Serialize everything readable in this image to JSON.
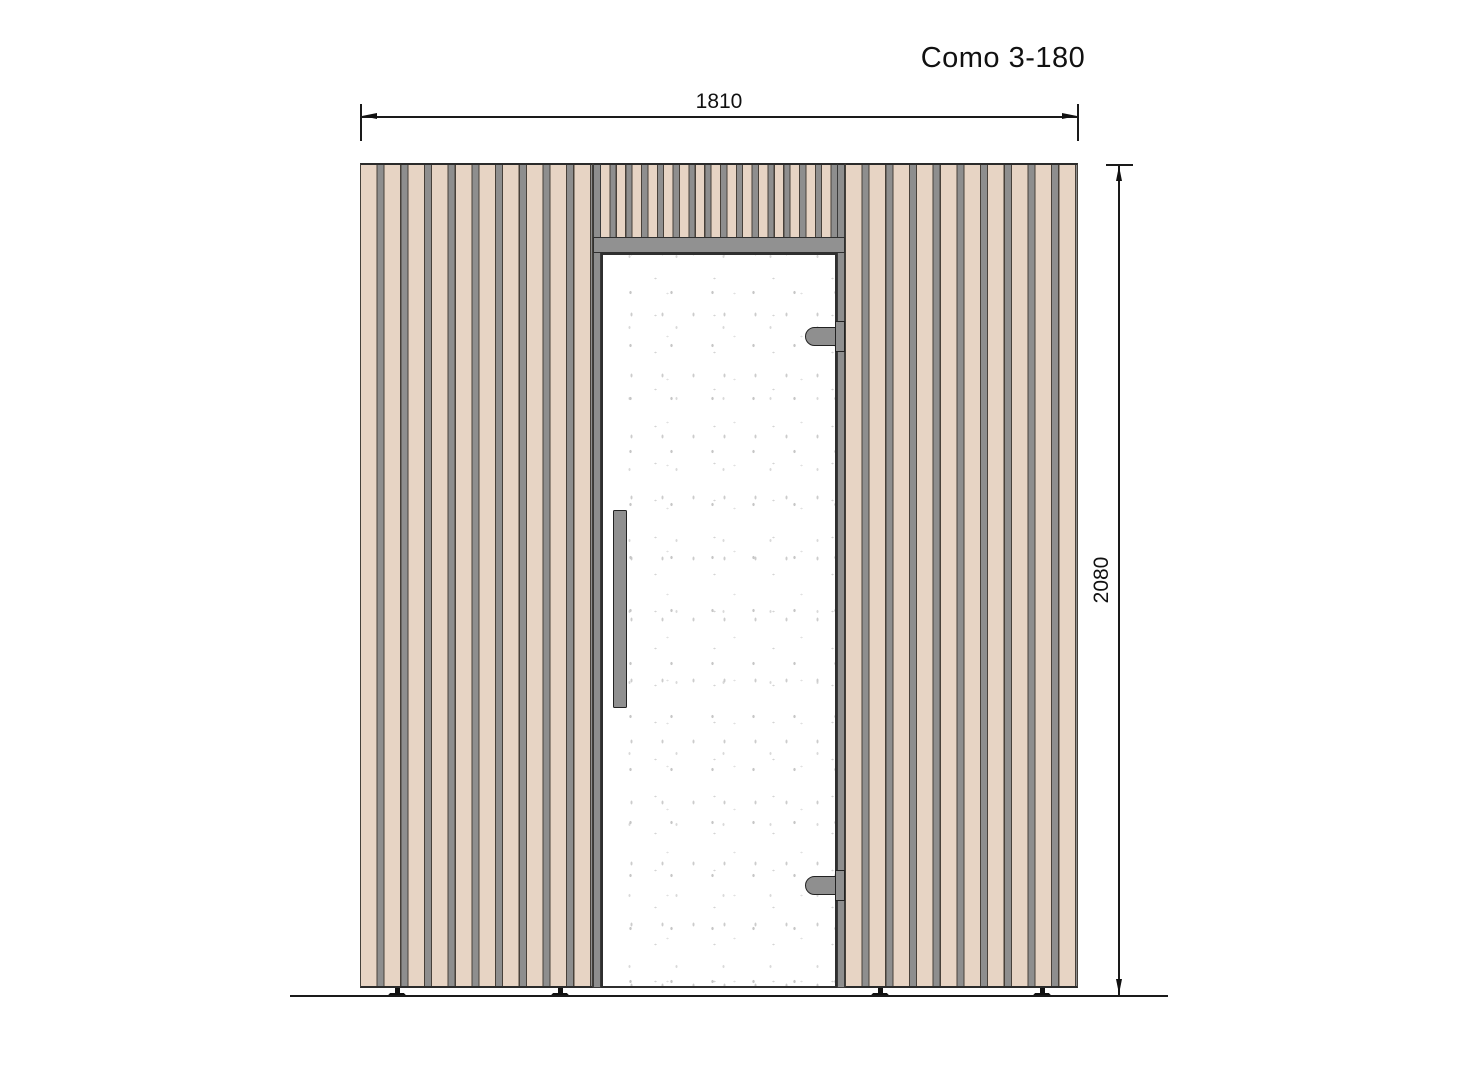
{
  "drawing": {
    "title": "Como 3-180",
    "view": "front elevation of sauna cabin with vertical slat cladding and glass door",
    "dimensions": {
      "width_mm": "1810",
      "height_mm": "2080"
    },
    "elements": {
      "door": "full-height glass door with vertical bar handle",
      "hinge_count": 2,
      "feet_count": 4
    },
    "colors": {
      "slat_beige": "#e7d4c4",
      "batten_gray": "#8e8e8e",
      "outline_dark": "#44403a",
      "header_gray": "#919191",
      "hardware_gray": "#8f8f8f",
      "hardware_outline": "#222222",
      "glass_speckle": "#cccccc",
      "line_black": "#1a1a1a",
      "background": "#ffffff"
    }
  }
}
